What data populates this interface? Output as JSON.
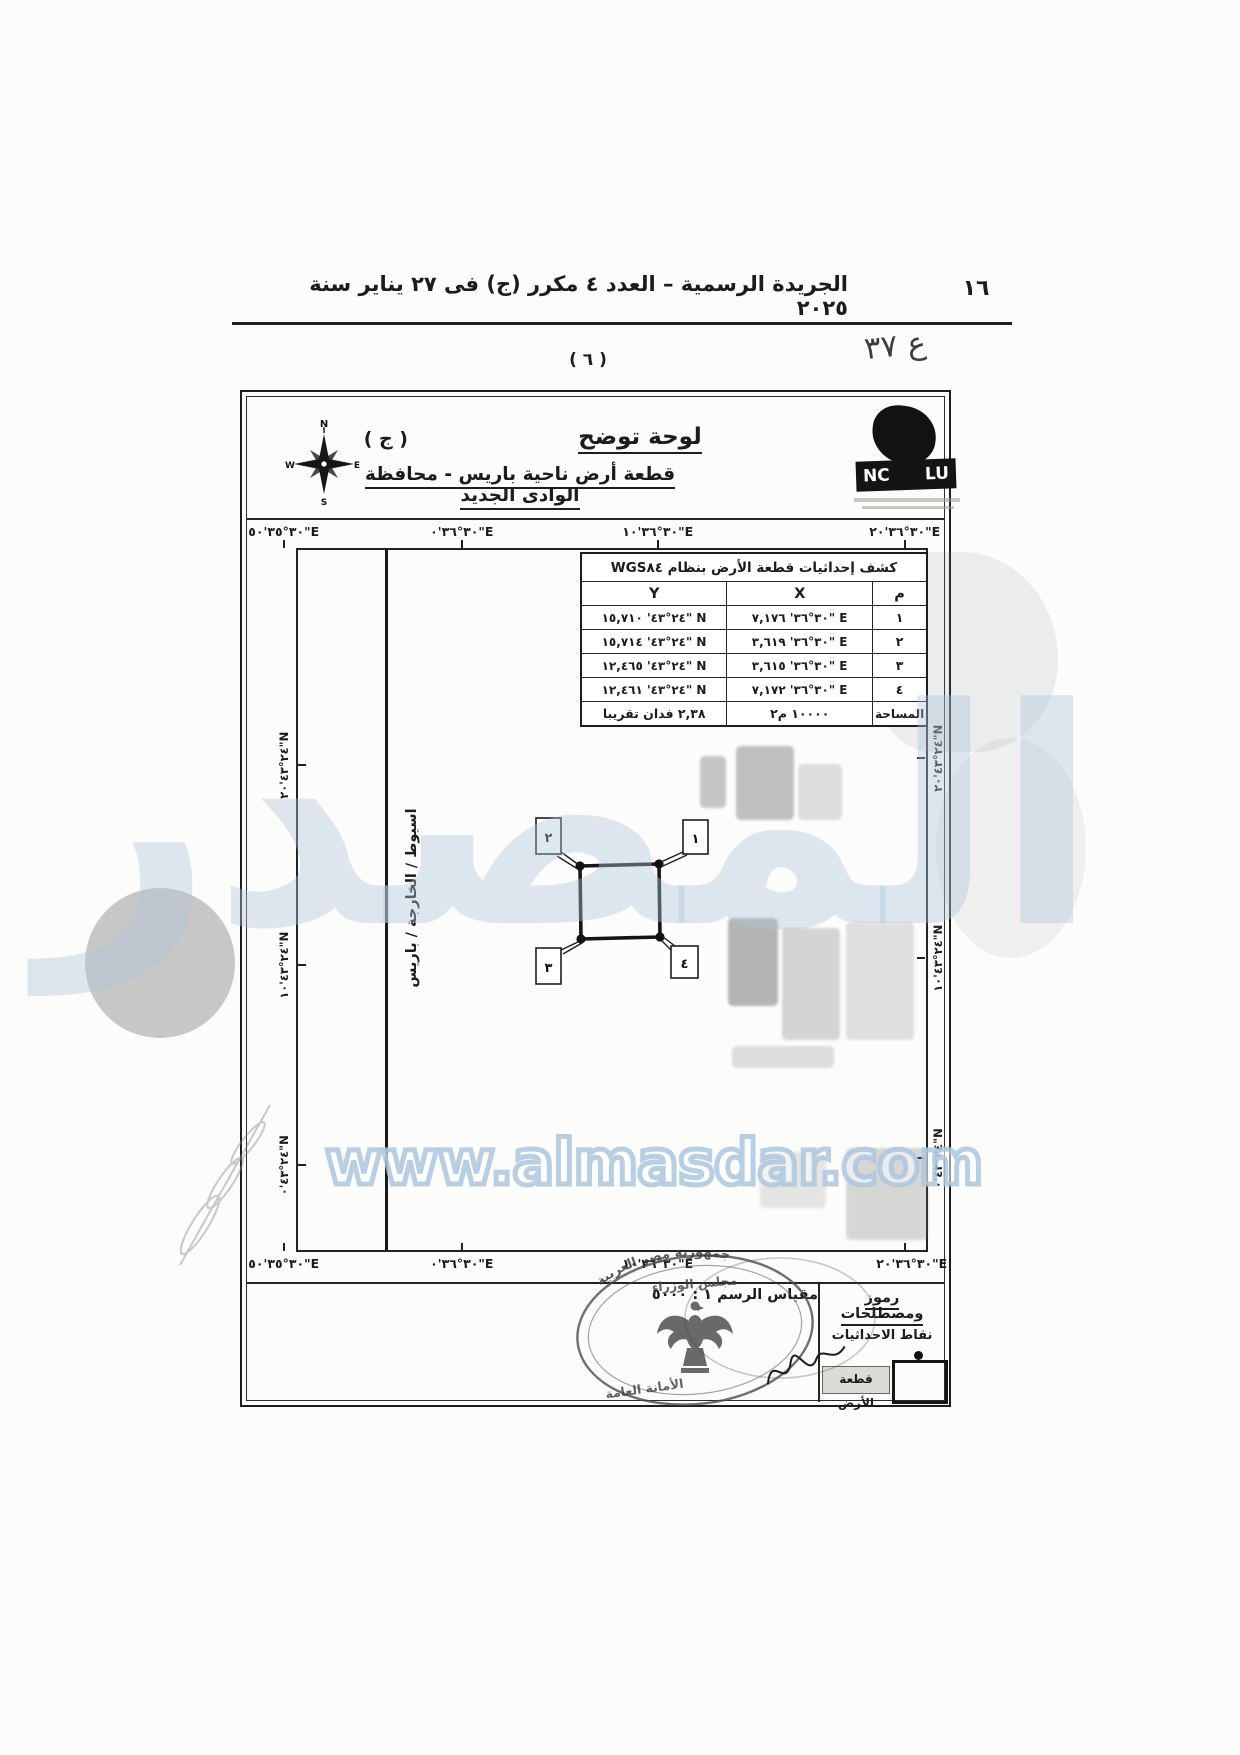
{
  "page": {
    "header_title": "الجريدة الرسمية – العدد ٤ مكرر (ج) فى ٢٧ يناير سنة ٢٠٢٥",
    "page_number": "١٦",
    "figure_number": "( ٦ )",
    "handwritten_note": "ع ٣٧"
  },
  "title_block": {
    "plate_letter": "( ج )",
    "title": "لوحة توضح",
    "subtitle": "قطعة أرض ناحية باريس - محافظة الوادى الجديد",
    "compass": {
      "north": "N",
      "east": "E",
      "south": "S",
      "west": "W"
    },
    "logo": {
      "left_text": "NC",
      "right_text": "LU"
    }
  },
  "coordinates_table": {
    "title": "كشف إحداثيات قطعة الأرض بنظام WGS٨٤",
    "col_point": "م",
    "col_x": "X",
    "col_y": "Y",
    "rows": [
      {
        "point": "١",
        "x": "٣٠°٣٦' ٧,١٧٦\" E",
        "y": "٢٤°٤٣' ١٥,٧١٠\" N"
      },
      {
        "point": "٢",
        "x": "٣٠°٣٦' ٣,٦١٩\" E",
        "y": "٢٤°٤٣' ١٥,٧١٤\" N"
      },
      {
        "point": "٣",
        "x": "٣٠°٣٦' ٣,٦١٥\" E",
        "y": "٢٤°٤٣' ١٢,٤٦٥\" N"
      },
      {
        "point": "٤",
        "x": "٣٠°٣٦' ٧,١٧٢\" E",
        "y": "٢٤°٤٣' ١٢,٤٦١\" N"
      }
    ],
    "area_label": "المساحة",
    "area_m2": "١٠٠٠٠ م٢",
    "area_feddan": "٢,٣٨ فدان تقريبا"
  },
  "map": {
    "longitude_labels": [
      "٣٠°٣٥'٥٠\"E",
      "٣٠°٣٦'٠\"E",
      "٣٠°٣٦'١٠\"E",
      "٣٠°٣٦'٢٠\"E"
    ],
    "latitude_labels": [
      "٢٤°٤٣'٢٠\"N",
      "٢٤°٤٣'١٠\"N",
      "٢٤°٤٣'٠\"N"
    ],
    "road_label": "اسيوط / الخارجة / باريس",
    "corner_labels": [
      "١",
      "٢",
      "٣",
      "٤"
    ]
  },
  "footer": {
    "scale_text": "مقياس الرسم ١ : ٥٠٠٠",
    "legend_title": "رموز ومصطلحات",
    "legend_point_label": "نقاط الاحداثيات",
    "legend_plot_label": "قطعة الأرض",
    "stamp_ring_top": "جمهورية مصر العربية",
    "stamp_ring_middle": "مجلس الوزراء",
    "stamp_ring_bottom": "الأمانة العامة"
  },
  "watermark": {
    "brand": "المصدر",
    "url": "www.almasdar.com",
    "color": "#b9cfe4"
  }
}
